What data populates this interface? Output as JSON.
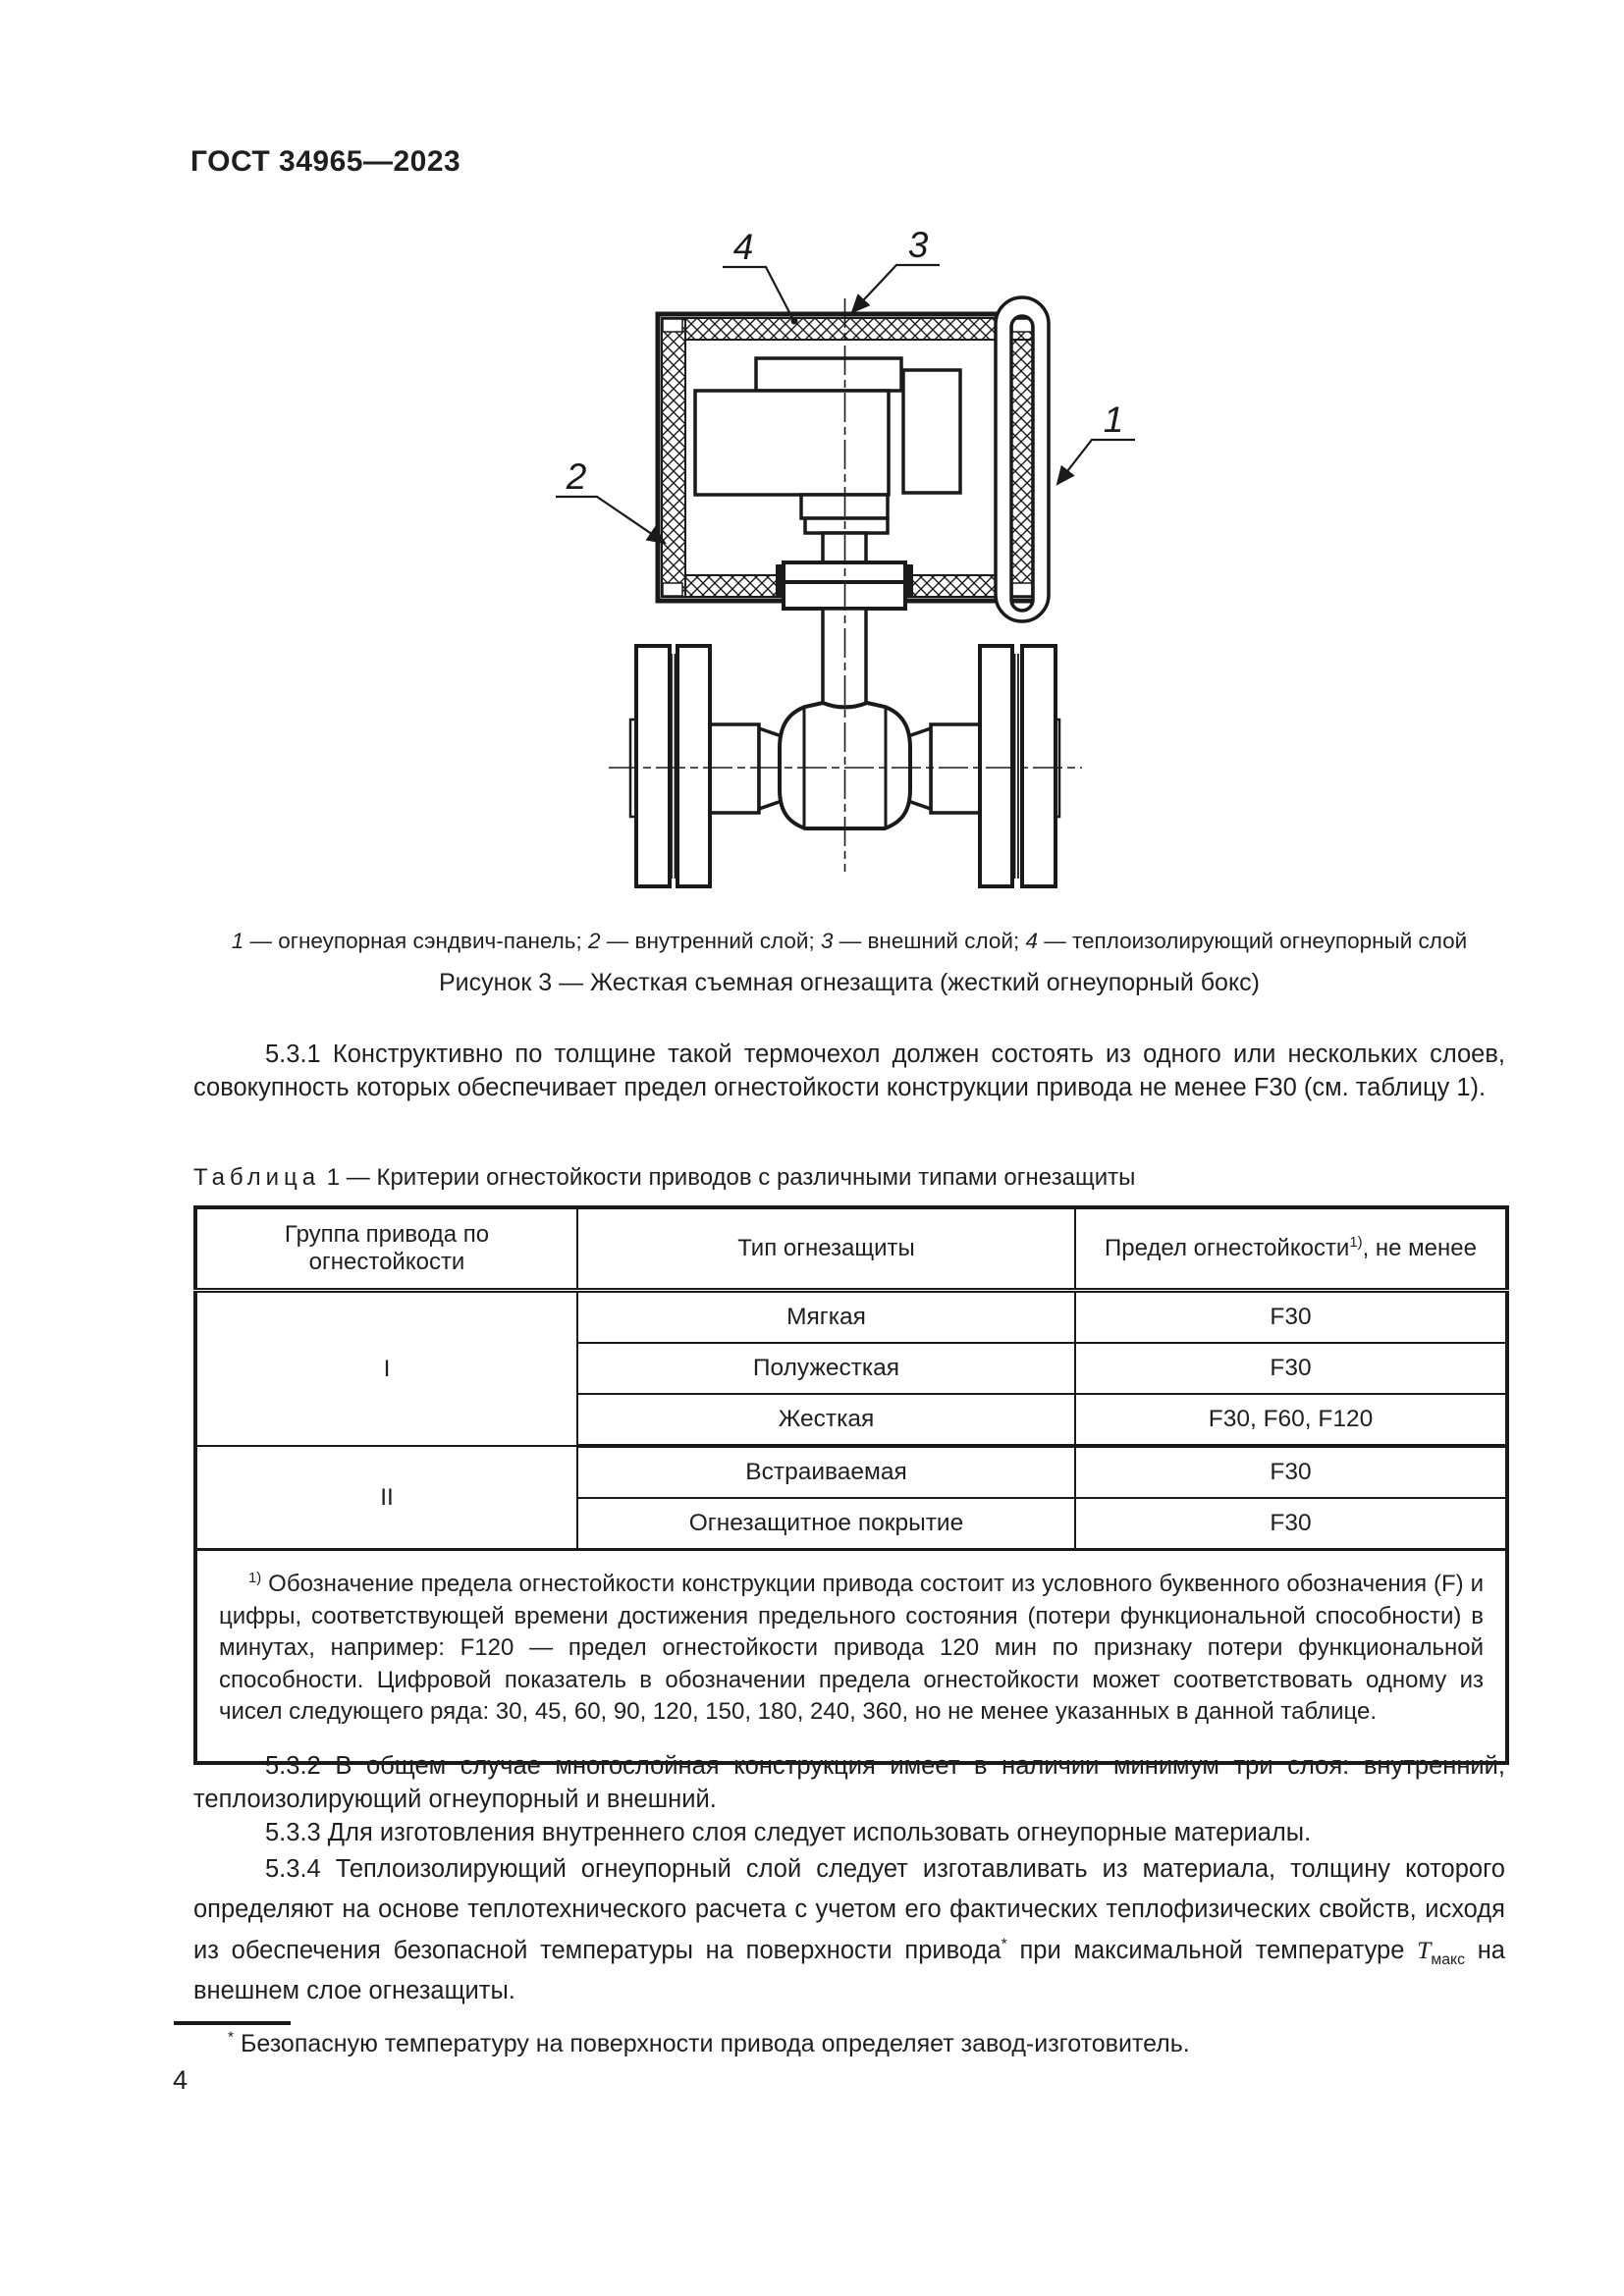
{
  "header": {
    "title": "ГОСТ 34965—2023"
  },
  "figure": {
    "callouts": {
      "c1": "1",
      "c2": "2",
      "c3": "3",
      "c4": "4"
    },
    "legend": [
      {
        "n": "1",
        "t": " — огнеупорная сэндвич-панель; "
      },
      {
        "n": "2",
        "t": " — внутренний слой; "
      },
      {
        "n": "3",
        "t": " — внешний слой; "
      },
      {
        "n": "4",
        "t": " — теплоизолирующий огнеупорный слой"
      }
    ],
    "caption": "Рисунок 3 — Жесткая съемная огнезащита (жесткий огнеупорный бокс)"
  },
  "sections": {
    "p531": "5.3.1 Конструктивно по толщине такой термочехол должен состоять из одного или нескольких слоев, совокупность которых обеспечивает предел огнестойкости конструкции привода не менее F30 (см. таблицу 1).",
    "p532": "5.3.2 В общем случае многослойная конструкция имеет в наличии минимум три слоя: внутренний, теплоизолирующий огнеупорный и внешний.",
    "p533": "5.3.3 Для изготовления внутреннего слоя следует использовать огнеупорные материалы.",
    "p534_a": "5.3.4 Теплоизолирующий огнеупорный слой следует изготавливать из материала, толщину которого определяют на основе теплотехнического расчета с учетом его фактических теплофизических свойств, исходя из обеспечения безопасной температуры на поверхности привода",
    "p534_star": "*",
    "p534_b": " при максимальной температуре ",
    "p534_t": "Т",
    "p534_tsub": "макс",
    "p534_c": " на внешнем слое огнезащиты."
  },
  "table": {
    "caption_word": "Таблица",
    "caption_rest": " 1 — Критерии огнестойкости приводов с различными типами огнезащиты",
    "col1": "Группа привода по огнестойкости",
    "col2": "Тип огнезащиты",
    "col3_a": "Предел огнестойкости",
    "col3_sup": "1)",
    "col3_b": ", не менее",
    "groups": [
      {
        "name": "I"
      },
      {
        "name": "II"
      }
    ],
    "rows": [
      {
        "type": "Мягкая",
        "limit": "F30"
      },
      {
        "type": "Полужесткая",
        "limit": "F30"
      },
      {
        "type": "Жесткая",
        "limit": "F30, F60, F120"
      },
      {
        "type": "Встраиваемая",
        "limit": "F30"
      },
      {
        "type": "Огнезащитное покрытие",
        "limit": "F30"
      }
    ],
    "footnote_sup": "1)",
    "footnote": " Обозначение предела огнестойкости конструкции привода состоит из условного буквенного обозначения (F) и цифры, соответствующей времени достижения предельного состояния (потери функциональной способности) в минутах, например: F120 — предел огнестойкости привода 120 мин по признаку потери функциональной способности. Цифровой показатель в обозначении предела огнестойкости может соответствовать одному из чисел следующего ряда: 30, 45, 60, 90, 120, 150, 180, 240, 360, но не менее указанных в данной таблице."
  },
  "footnote": {
    "star": "*",
    "text": " Безопасную температуру на поверхности привода определяет завод-изготовитель."
  },
  "page": {
    "number": "4"
  },
  "colors": {
    "ink": "#1a1a1a",
    "paper": "#ffffff"
  }
}
